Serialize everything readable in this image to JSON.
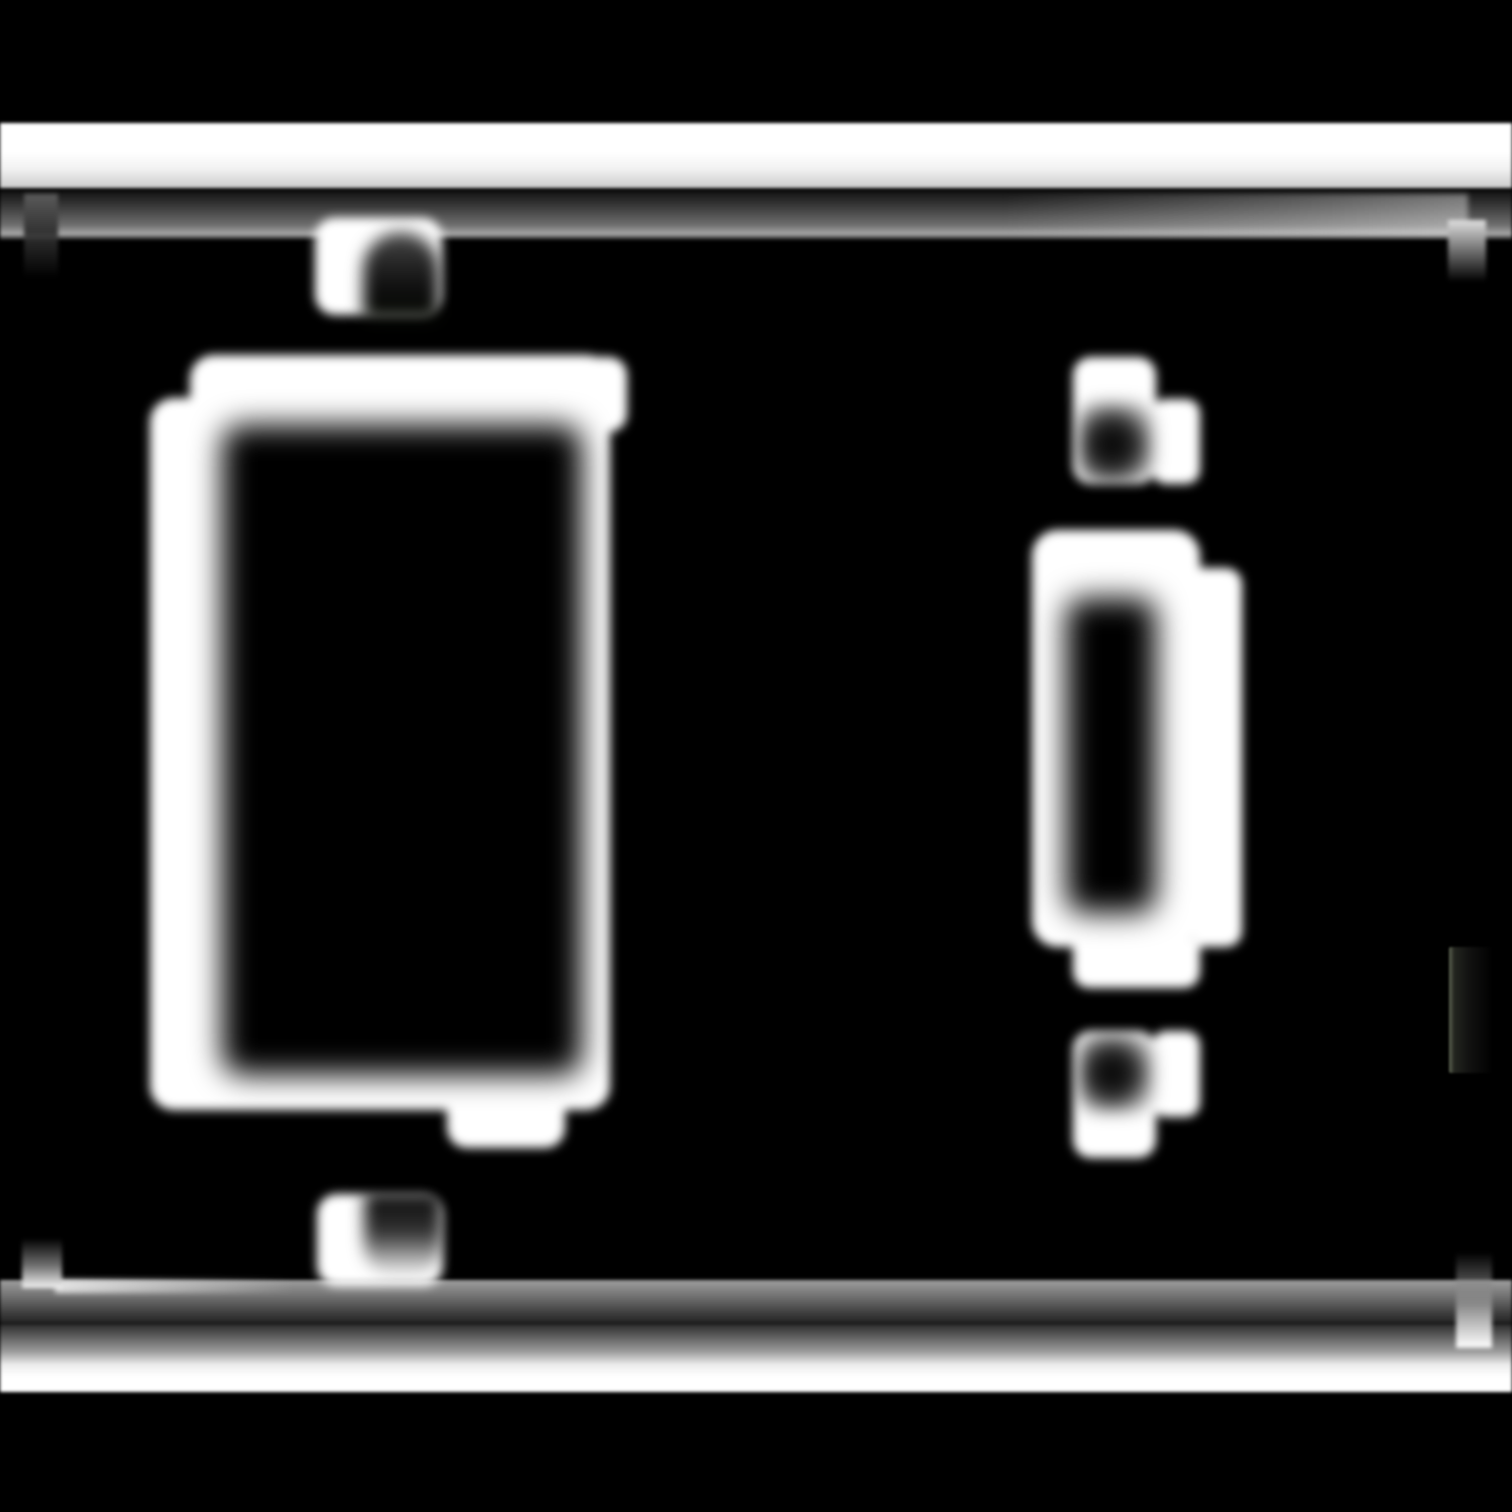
{
  "image": {
    "title": "Blurred black-and-white mask of a two-gang wall plate: large rectangular decora opening on the left, narrow toggle-switch slot on the right, four screw heads with dark slots, horizontal plate edge lines at top and bottom with corner hooks, faint ghost mark at right edge",
    "width": 1512,
    "height": 1512,
    "background_color": "#000000",
    "foreground_color": "#ffffff"
  },
  "layers": [
    {
      "name": "plate-edge-bands",
      "blur": 1.5,
      "shapes": [
        {
          "name": "top-outer-edge-band",
          "x": 0,
          "y": 123,
          "w": 1512,
          "h": 65,
          "radius": "0",
          "fill": "linear-gradient(180deg, #ffffff 0%, #ffffff 45%, #f2f2f2 70%, #cccccc 100%)"
        },
        {
          "name": "top-inner-edge-band",
          "x": 0,
          "y": 191,
          "w": 1512,
          "h": 49,
          "radius": "0",
          "fill": "linear-gradient(180deg, #121212 0%, #3f3f3f 35%, #6f6f6f 70%, #a8a8a8 88%, #161616 100%)"
        },
        {
          "name": "bottom-inner-edge-band",
          "x": 0,
          "y": 1280,
          "w": 1512,
          "h": 43,
          "radius": "0",
          "fill": "linear-gradient(180deg, #9f9f9f 0%, #6f6f6f 40%, #3a3a3a 80%, #242424 100%)"
        },
        {
          "name": "bottom-outer-edge-band",
          "x": 0,
          "y": 1324,
          "w": 1512,
          "h": 68,
          "radius": "0",
          "fill": "linear-gradient(180deg, #2c2c2c 0%, #9a9a9a 40%, #ededed 60%, #ffffff 78%, #ffffff 100%)"
        }
      ]
    },
    {
      "name": "band-highlights",
      "blur": 3,
      "shapes": [
        {
          "name": "top-inner-right-highlight",
          "x": 1000,
          "y": 194,
          "w": 468,
          "h": 42,
          "radius": "0",
          "fill": "linear-gradient(90deg, rgba(255,255,255,0) 0%, rgba(255,255,255,0.22) 60%, rgba(255,255,255,0.4) 100%)"
        },
        {
          "name": "bottom-inner-left-highlight",
          "x": 55,
          "y": 1279,
          "w": 240,
          "h": 14,
          "radius": "0",
          "fill": "linear-gradient(90deg, rgba(255,255,255,0.75) 0%, rgba(255,255,255,0) 100%)"
        }
      ]
    },
    {
      "name": "corner-hooks",
      "blur": 2,
      "shapes": [
        {
          "name": "top-left-hook",
          "x": 24,
          "y": 194,
          "w": 34,
          "h": 84,
          "radius": "0 0 4px 4px",
          "fill": "linear-gradient(180deg, #5a5a5a 0%, #333333 45%, rgba(20,20,20,0) 100%)"
        },
        {
          "name": "top-right-hook",
          "x": 1448,
          "y": 220,
          "w": 38,
          "h": 62,
          "radius": "0 0 4px 4px",
          "fill": "linear-gradient(180deg, #e0e0e0 0%, #7a7a7a 45%, rgba(30,30,30,0) 100%)"
        },
        {
          "name": "bottom-left-hook",
          "x": 22,
          "y": 1238,
          "w": 40,
          "h": 50,
          "radius": "4px 4px 0 0",
          "fill": "linear-gradient(180deg, rgba(30,30,30,0) 0%, #6f6f6f 55%, #f5f5f5 100%)"
        },
        {
          "name": "bottom-right-hook",
          "x": 1456,
          "y": 1252,
          "w": 36,
          "h": 96,
          "radius": "4px 4px 0 0",
          "fill": "linear-gradient(180deg, rgba(40,40,40,0) 0%, #8a8a8a 55%, #ffffff 100%)"
        }
      ]
    },
    {
      "name": "plate-white-shapes",
      "blur": 5,
      "shapes": [
        {
          "name": "decora-frame-main",
          "x": 190,
          "y": 355,
          "w": 420,
          "h": 755,
          "radius": "24px",
          "fill": "#ffffff"
        },
        {
          "name": "decora-frame-offset",
          "x": 150,
          "y": 398,
          "w": 420,
          "h": 712,
          "radius": "24px",
          "fill": "#ffffff"
        },
        {
          "name": "decora-frame-top-right-corner",
          "x": 595,
          "y": 357,
          "w": 32,
          "h": 75,
          "radius": "0 18px 18px 0",
          "fill": "#ffffff"
        },
        {
          "name": "decora-frame-bottom-tab",
          "x": 447,
          "y": 1058,
          "w": 118,
          "h": 90,
          "radius": "0 0 20px 20px",
          "fill": "#ffffff"
        },
        {
          "name": "screw-head-top-left",
          "x": 315,
          "y": 218,
          "w": 127,
          "h": 97,
          "radius": "20px",
          "fill": "#ffffff"
        },
        {
          "name": "screw-head-bottom-left",
          "x": 317,
          "y": 1194,
          "w": 126,
          "h": 92,
          "radius": "20px",
          "fill": "#ffffff"
        },
        {
          "name": "toggle-frame-main",
          "x": 1032,
          "y": 530,
          "w": 168,
          "h": 417,
          "radius": "26px",
          "fill": "#ffffff"
        },
        {
          "name": "toggle-frame-right-column",
          "x": 1194,
          "y": 568,
          "w": 48,
          "h": 379,
          "radius": "0 16px 16px 0",
          "fill": "#ffffff"
        },
        {
          "name": "toggle-frame-bottom-tab",
          "x": 1073,
          "y": 940,
          "w": 127,
          "h": 48,
          "radius": "0 0 16px 16px",
          "fill": "#ffffff"
        },
        {
          "name": "screw-head-top-right",
          "x": 1073,
          "y": 357,
          "w": 83,
          "h": 127,
          "radius": "18px",
          "fill": "#ffffff"
        },
        {
          "name": "screw-head-top-right-lobe",
          "x": 1152,
          "y": 399,
          "w": 48,
          "h": 85,
          "radius": "14px",
          "fill": "#ffffff"
        },
        {
          "name": "screw-head-bottom-right",
          "x": 1073,
          "y": 1031,
          "w": 83,
          "h": 127,
          "radius": "18px",
          "fill": "#ffffff"
        },
        {
          "name": "screw-head-bottom-right-lobe",
          "x": 1152,
          "y": 1031,
          "w": 48,
          "h": 86,
          "radius": "14px",
          "fill": "#ffffff"
        }
      ]
    },
    {
      "name": "openings-cutouts",
      "blur": 15,
      "shapes": [
        {
          "name": "decora-opening-cutout",
          "x": 222,
          "y": 425,
          "w": 360,
          "h": 650,
          "radius": "20px",
          "fill": "#000000"
        },
        {
          "name": "toggle-slot-cutout",
          "x": 1066,
          "y": 598,
          "w": 90,
          "h": 315,
          "radius": "18px",
          "fill": "#000000"
        }
      ]
    },
    {
      "name": "screw-slots",
      "blur": 8,
      "shapes": [
        {
          "name": "screw-slot-top-left",
          "x": 363,
          "y": 232,
          "w": 76,
          "h": 88,
          "radius": "38px 38px 8px 8px",
          "fill": "linear-gradient(180deg, #4c4c4c 0%, #262626 35%, #0b0b0b 70%, #0d1109 100%)"
        },
        {
          "name": "screw-slot-bottom-left",
          "x": 364,
          "y": 1192,
          "w": 78,
          "h": 86,
          "radius": "8px 8px 34px 34px",
          "fill": "linear-gradient(180deg, rgba(0,0,0,0.95) 0%, rgba(10,10,10,0.85) 45%, rgba(40,40,40,0.35) 80%, rgba(255,255,255,0) 100%)"
        },
        {
          "name": "screw-slot-top-right",
          "x": 1078,
          "y": 402,
          "w": 76,
          "h": 82,
          "radius": "18px",
          "fill": "radial-gradient(circle at 45% 52%, #000000 0%, rgba(0,0,0,0.85) 40%, rgba(0,0,0,0.25) 75%, rgba(0,0,0,0) 100%)"
        },
        {
          "name": "screw-slot-bottom-right",
          "x": 1078,
          "y": 1033,
          "w": 76,
          "h": 80,
          "radius": "18px",
          "fill": "radial-gradient(circle at 45% 50%, #000000 0%, rgba(0,0,0,0.85) 40%, rgba(0,0,0,0.25) 75%, rgba(0,0,0,0) 100%)"
        }
      ]
    },
    {
      "name": "artifacts",
      "blur": 1,
      "shapes": [
        {
          "name": "right-edge-ghost-mark",
          "x": 1449,
          "y": 947,
          "w": 44,
          "h": 126,
          "radius": "2px",
          "fill": "linear-gradient(90deg, #5f6654 0%, #23251f 12%, #121211 45%, #000000 100%)"
        }
      ]
    }
  ]
}
